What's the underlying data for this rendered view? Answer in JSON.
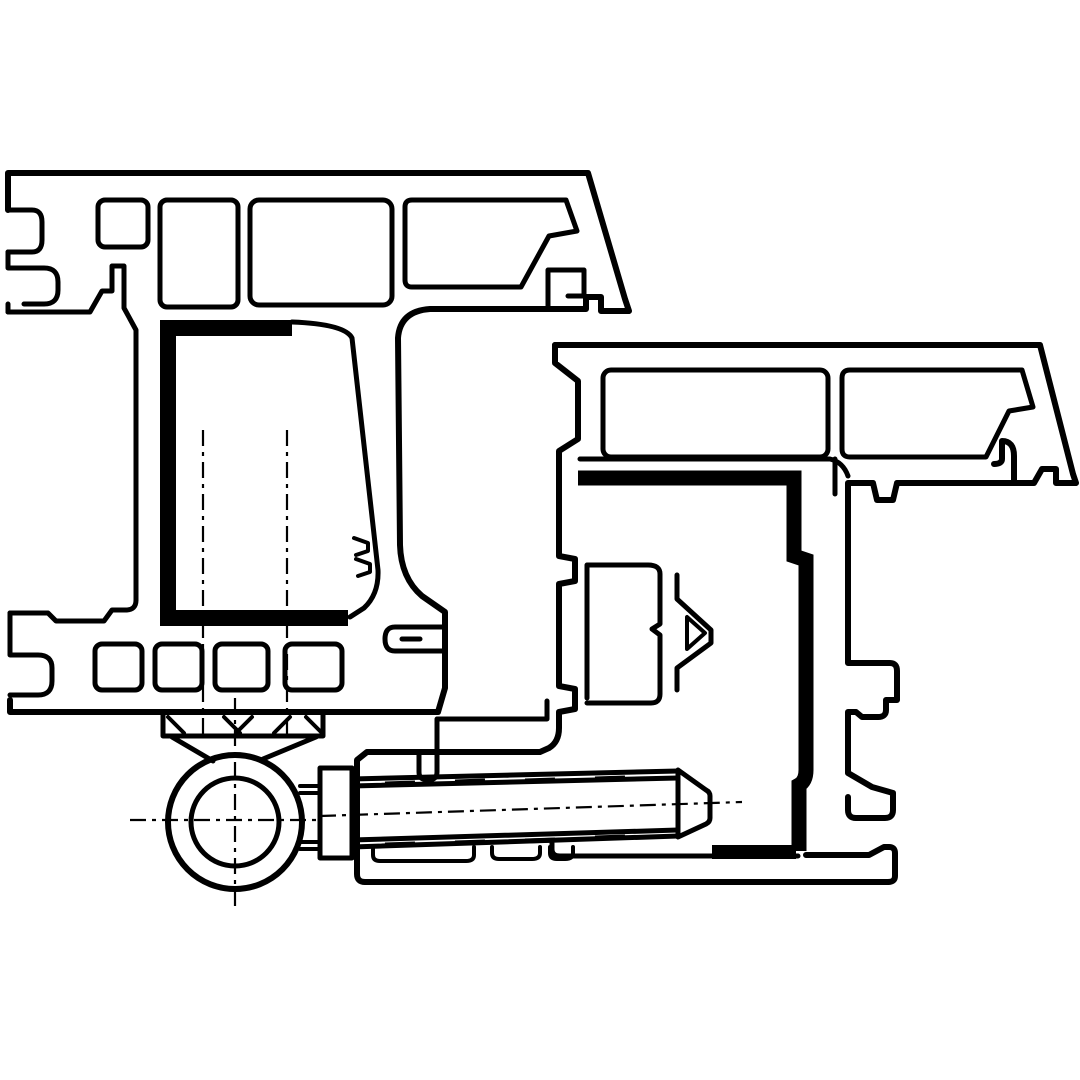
{
  "diagram": {
    "description": "Technical cross-section drawing of two PVC window profiles (frame and sash) joined by a surface-mounted hinge: hinge knuckle with pin shown as concentric circles, fixing screw shown in side view entering the sash profile, black co-extruded sealing gaskets, dash-dot centre lines and machining hatch marks.",
    "type": "engineering-cross-section",
    "parts": [
      {
        "name": "frame-profile",
        "label": "Upper-left multi-chamber frame profile"
      },
      {
        "name": "sash-profile",
        "label": "Lower-right multi-chamber sash profile"
      },
      {
        "name": "frame-gasket",
        "label": "Thick black seal in frame rebate"
      },
      {
        "name": "sash-gasket",
        "label": "Thick black seal in sash rebate"
      },
      {
        "name": "hinge-knuckle",
        "label": "Hinge knuckle / pin barrel"
      },
      {
        "name": "hinge-screw",
        "label": "Horizontal fixing screw with thread"
      },
      {
        "name": "mounting-block",
        "label": "Hinge mounting block with hatch marks"
      },
      {
        "name": "center-lines",
        "label": "Dash-dot centre lines"
      }
    ]
  },
  "colors": {
    "ink": "#000000",
    "background": "#ffffff",
    "seal": "#000000"
  }
}
